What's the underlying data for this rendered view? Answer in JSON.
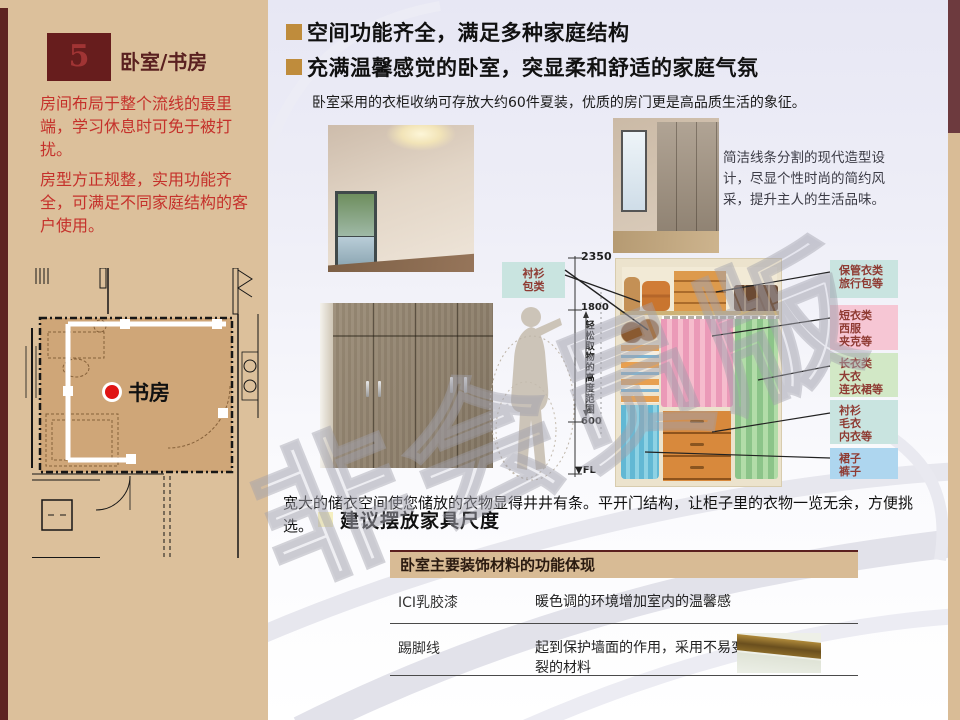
{
  "colors": {
    "maroon": "#6e2a28",
    "sidebar_tan": "#dcc09b",
    "accent_orange": "#bf8c3c",
    "red_text": "#c5312b",
    "label_text": "#8f3b33",
    "teal_box": "#c9e4e0",
    "pink_box": "#f6c6d4",
    "green_box": "#d2e8c6",
    "blue_box": "#aed6ef",
    "pale_yellow_bullet": "#f5efc0"
  },
  "sidebar": {
    "number": "5",
    "title": "卧室/书房",
    "paragraphs": [
      "房间布局于整个流线的最里端，学习休息时可免于被打扰。",
      "房型方正规整，实用功能齐全，可满足不同家庭结构的客户使用。"
    ],
    "floorplan_label": "书房"
  },
  "headers": [
    "空间功能齐全，满足多种家庭结构",
    "充满温馨感觉的卧室，突显柔和舒适的家庭气氛"
  ],
  "intro": "卧室采用的衣柜收纳可存放大约60件夏装，优质的房门更是高品质生活的象征。",
  "wardrobe_caption": "简洁线条分割的现代造型设计，尽显个性时尚的简约风采，提升主人的生活品味。",
  "diagram": {
    "left_box": {
      "lines": [
        "衬衫",
        "包类"
      ]
    },
    "dims": {
      "top": "2350",
      "upper": "1800",
      "lower": "600",
      "floor": "▼FL"
    },
    "range_label": "轻松取物的高度范围",
    "labels": [
      {
        "lines": [
          "保管衣类",
          "旅行包等"
        ]
      },
      {
        "lines": [
          "短衣类",
          "西服",
          "夹克等"
        ]
      },
      {
        "lines": [
          "长衣类",
          "大衣",
          "连衣裙等"
        ]
      },
      {
        "lines": [
          "衬衫",
          "毛衣",
          "内衣等"
        ]
      },
      {
        "lines": [
          "裙子",
          "裤子"
        ]
      }
    ]
  },
  "body_text": "宽大的储衣空间使您储放的衣物显得井井有条。平开门结构，让柜子里的衣物一览无余，方便挑选。",
  "section_title": "建议摆放家具尺度",
  "table": {
    "title": "卧室主要装饰材料的功能体现",
    "rows": [
      {
        "name": "ICI乳胶漆",
        "desc": "暖色调的环境增加室内的温馨感"
      },
      {
        "name": "踢脚线",
        "desc": "起到保护墙面的作用，采用不易变形开裂的材料"
      }
    ]
  },
  "watermark": "非会员版"
}
